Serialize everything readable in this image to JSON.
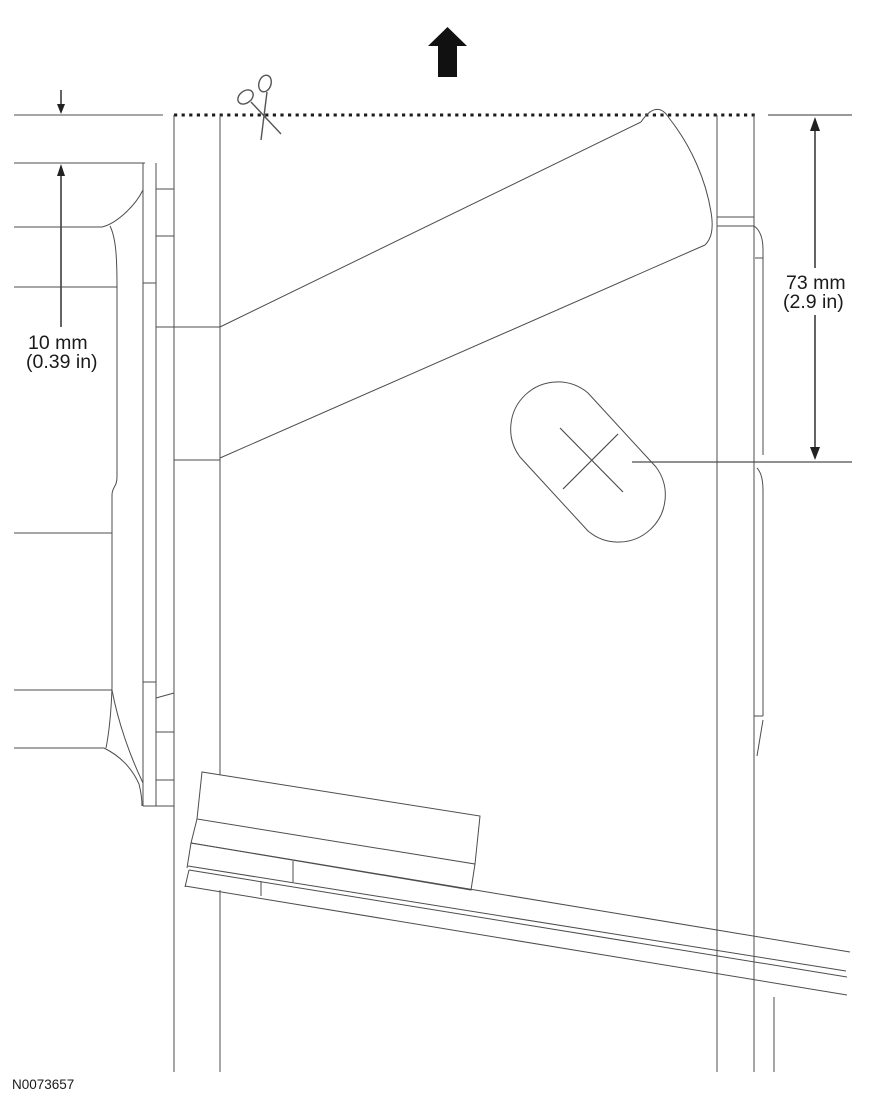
{
  "figure": {
    "id_label": "N0073657",
    "background_color": "#ffffff",
    "line_color": "#4d4d4d",
    "accent_color": "#111111"
  },
  "dimensions": {
    "left": {
      "value_metric": "10 mm",
      "value_imperial": "(0.39 in)"
    },
    "right": {
      "value_metric": "73 mm",
      "value_imperial": "(2.9 in)"
    }
  },
  "icons": {
    "scissors": "scissors-icon",
    "direction_arrow": "up-arrow-icon"
  }
}
